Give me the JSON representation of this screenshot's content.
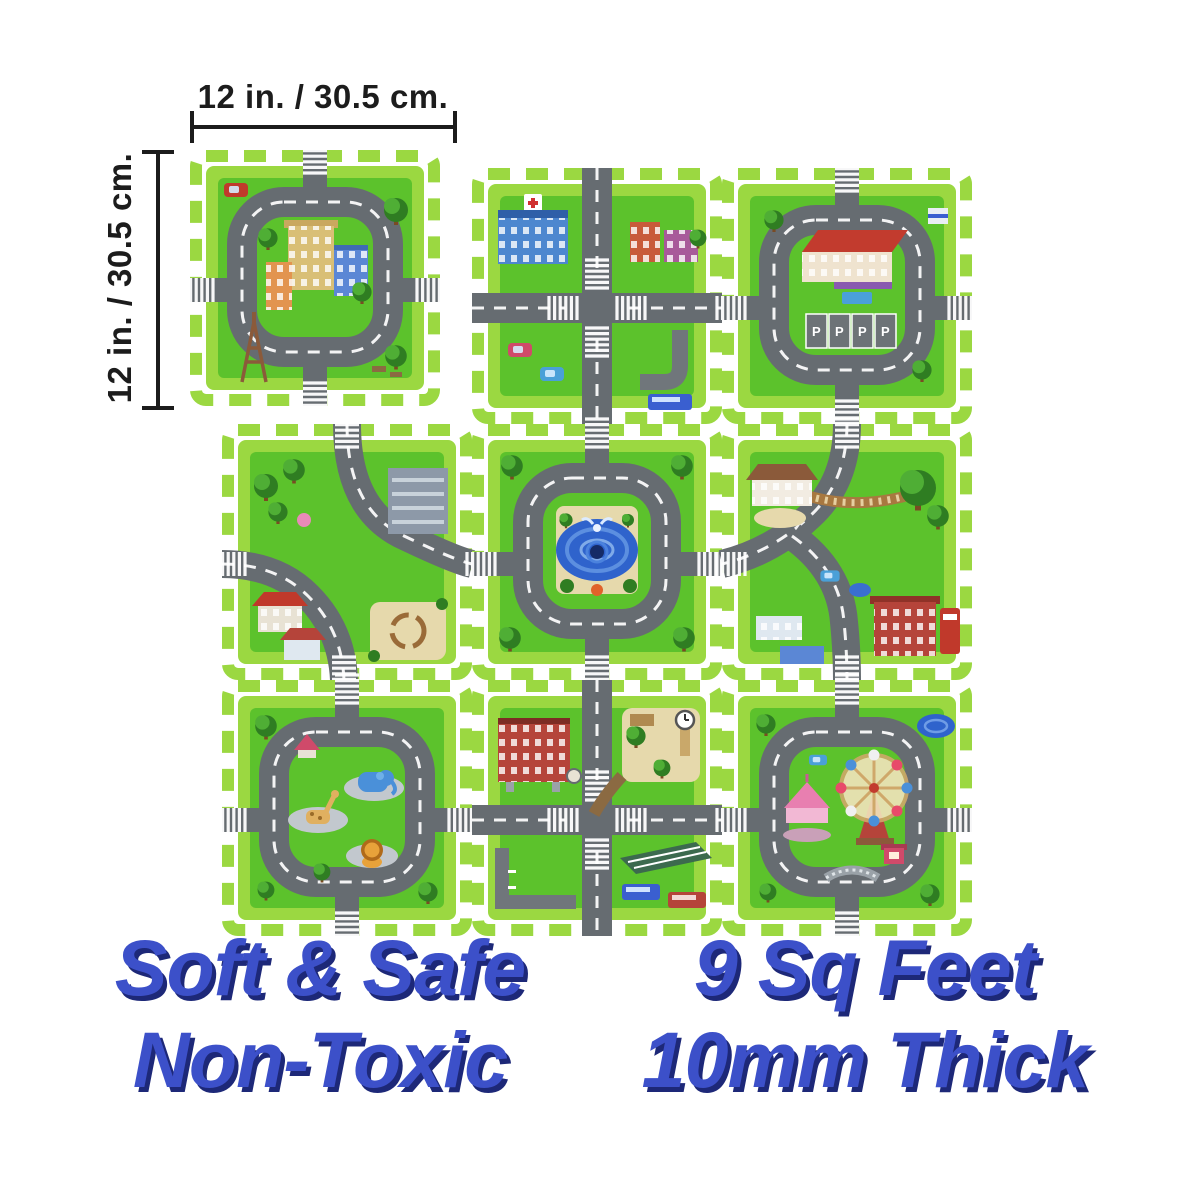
{
  "dimensions": {
    "width_label": "12 in. / 30.5 cm.",
    "height_label": "12 in. / 30.5 cm."
  },
  "claims": {
    "soft_safe": "Soft & Safe",
    "non_toxic": "Non-Toxic",
    "area": "9 Sq Feet",
    "thickness": "10mm Thick"
  },
  "mat": {
    "layout": "3x3 interlocking foam play mat, top-left tile shown detached with size callouts",
    "parking_label": "P",
    "tiles": [
      {
        "id": "detached-tile-city-block",
        "label": "city block with Eiffel tower"
      },
      {
        "id": "tile-hospital-crossroads",
        "label": "hospital crossroads"
      },
      {
        "id": "tile-school-parking",
        "label": "school with parking bays"
      },
      {
        "id": "tile-park-curves",
        "label": "park and houses curves"
      },
      {
        "id": "tile-fountain-roundabout",
        "label": "central fountain roundabout"
      },
      {
        "id": "tile-villa-bridge",
        "label": "villa, bridge and fire station"
      },
      {
        "id": "tile-zoo-animals",
        "label": "zoo animals loop"
      },
      {
        "id": "tile-clock-park",
        "label": "clock tower park and bus stop"
      },
      {
        "id": "tile-funfair",
        "label": "ferris wheel and carousel"
      }
    ]
  },
  "colors": {
    "background": "#ffffff",
    "grass": "#5cc22c",
    "tab_green": "#9bd841",
    "road": "#666c71",
    "road_light": "#8f969b",
    "sand": "#e6d9ac",
    "pond_blue": "#2f63cc",
    "dimension_ink": "#1c1c1c",
    "claim_blue": "#3c50c9",
    "claim_shadow": "#1d2878"
  }
}
